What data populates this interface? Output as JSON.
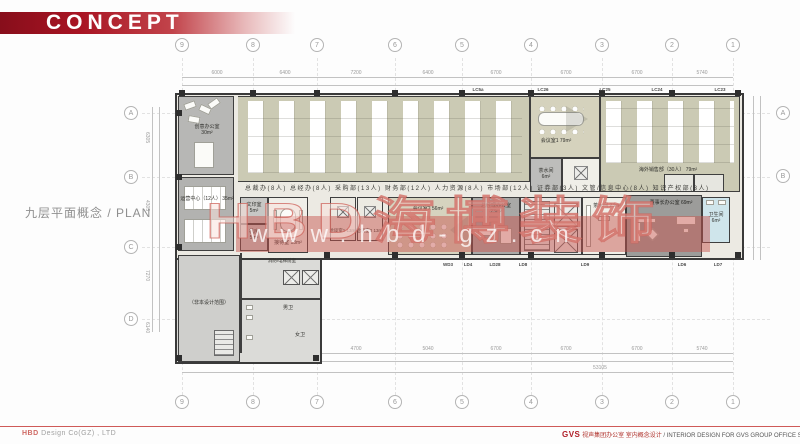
{
  "header": {
    "title": "CONCEPT"
  },
  "plan_title": {
    "text": "九层平面概念 / PLAN"
  },
  "watermark": {
    "logo": "HBD海博装饰",
    "url": "www.hbd-gz.cn"
  },
  "grid": {
    "top": [
      "9",
      "8",
      "7",
      "6",
      "5",
      "4",
      "3",
      "2",
      "1"
    ],
    "bottom": [
      "9",
      "8",
      "7",
      "6",
      "5",
      "4",
      "3",
      "2",
      "1"
    ],
    "left": [
      "A",
      "B",
      "C",
      "D"
    ],
    "right": [
      "A",
      "B"
    ]
  },
  "dimensions": {
    "top": [
      "6000",
      "6400",
      "7200",
      "6400",
      "6700",
      "6700",
      "6700",
      "5740"
    ],
    "bottom": [
      "5950",
      "5600",
      "4700",
      "5040",
      "6700",
      "6700",
      "6700",
      "5740"
    ],
    "left": [
      "6305",
      "4305",
      "7270",
      "6140"
    ],
    "overall": "53105"
  },
  "door_codes": {
    "top": [
      "LC5a",
      "LC26",
      "LC25",
      "LC24",
      "LC23"
    ],
    "bottom": [
      "WD3",
      "LD4",
      "LD28",
      "LD8",
      "LD9",
      "LD6",
      "LD7"
    ]
  },
  "rooms": {
    "creative": {
      "name": "创意办公室",
      "area": "30m²"
    },
    "ops": {
      "name": "运营中心（12人）",
      "area": "35m²"
    },
    "out_scope": {
      "name": "（非本设计范围）"
    },
    "print": {
      "name": "文印室",
      "area": "5m²"
    },
    "server": {
      "name": "机房",
      "area": "5m²"
    },
    "lobby": {
      "name": "消防/电梯前室"
    },
    "wc_m": {
      "name": "男卫"
    },
    "wc_f": {
      "name": "女卫"
    },
    "reception": {
      "name": "接待室",
      "area": "13m²"
    },
    "talk1": {
      "name": "洽谈室1",
      "area": "13m²"
    },
    "talk2": {
      "name": "洽谈室2",
      "area": "13m²"
    },
    "meeting2": {
      "name": "会议室2",
      "area": "56m²"
    },
    "gm": {
      "name": "总经理办公室",
      "area": "23m²"
    },
    "pantry": {
      "name": "茶水间",
      "area": "23m²"
    },
    "chairman": {
      "name": "董事长办公室",
      "area": "69m²"
    },
    "wc_exec": {
      "name": "卫生间",
      "area": "6m²"
    },
    "meeting1": {
      "name": "会议室1",
      "area": "79m²"
    },
    "tea1": {
      "name": "茶水间",
      "area": "6m²"
    },
    "overseas": {
      "name": "海外销售部（30人）",
      "area": "79m²"
    }
  },
  "caption": {
    "departments": "总裁办(8人)  总经办(8人)  采购部(13人)  财务部(12人)  人力资源(8人)  市场部(12人)  证券部(3人)  文管/信息中心(8人)  知识产权部(3人)"
  },
  "footer": {
    "company": "Design Co(GZ) , LTD",
    "company_brand": "HBD",
    "brand": "GVS",
    "project_cn": "视声集团办公室 室内概念设计",
    "project_en": " / INTERIOR DESIGN FOR GVS GROUP OFFICE SPACE"
  },
  "colors": {
    "accent_red": "#b01e28",
    "wall": "#3f3f3f",
    "office_floor": "#cbcab4"
  }
}
